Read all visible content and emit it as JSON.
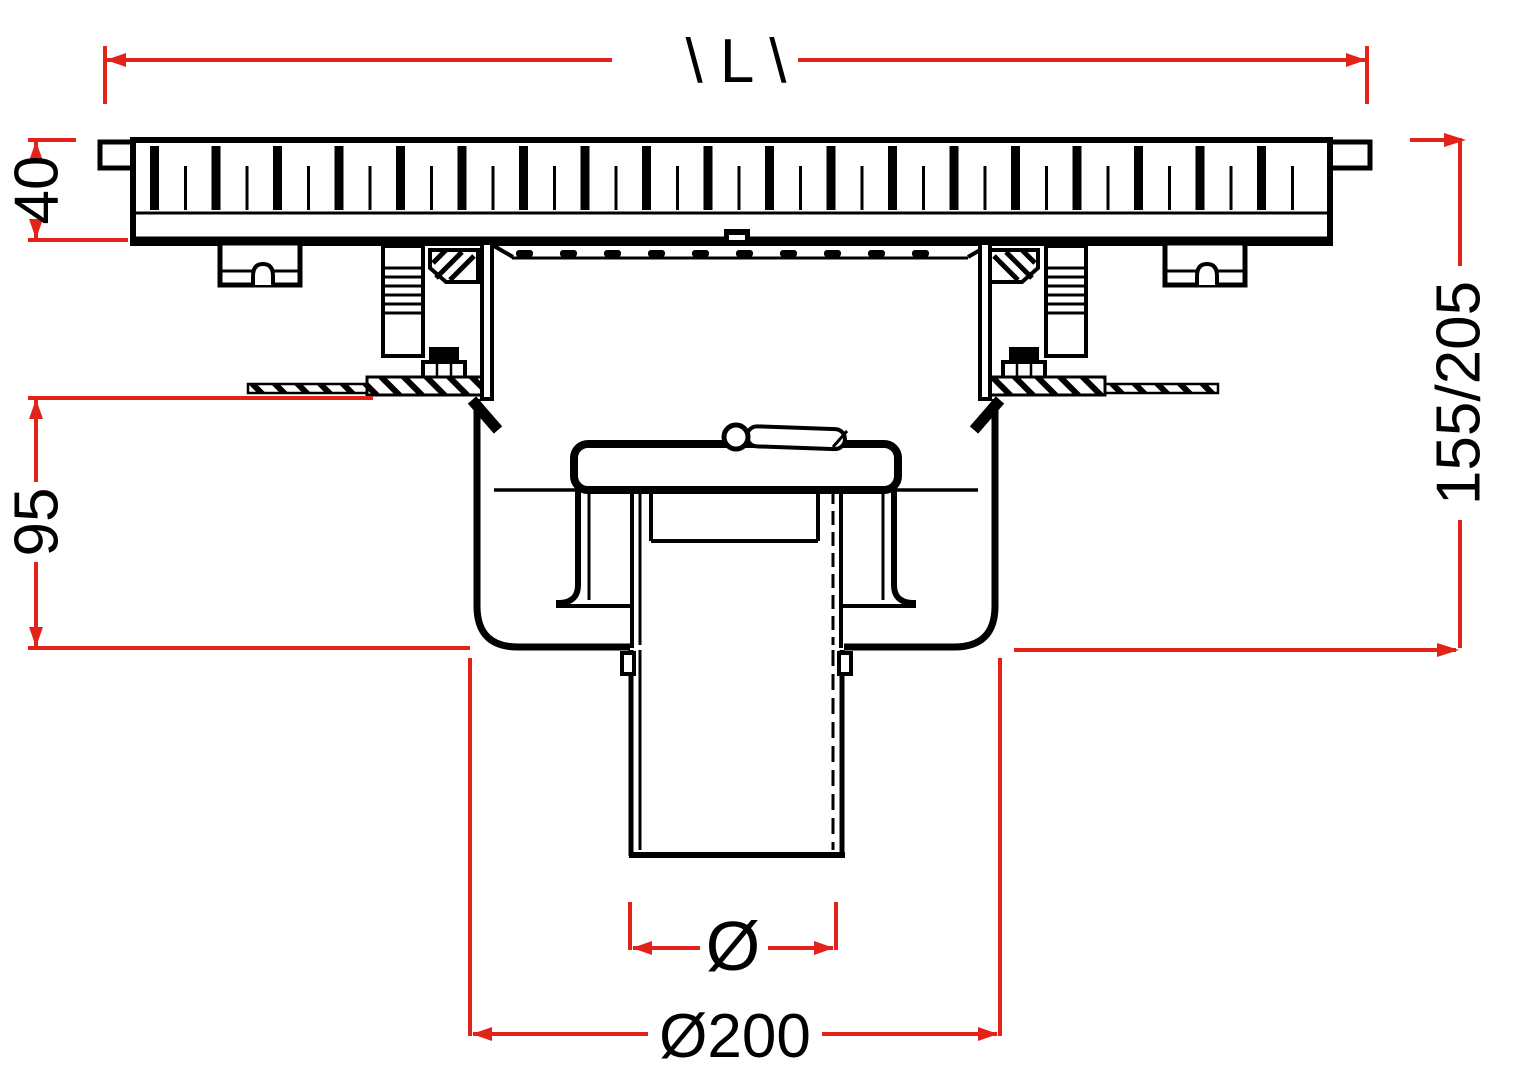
{
  "drawing": {
    "type": "floor-drain cross-section, dimensioned technical drawing",
    "colors": {
      "line": "#000000",
      "dimension": "#e2231a",
      "background": "#ffffff"
    }
  },
  "dimensions": {
    "length_label": "\\ L \\",
    "grate_height": "40",
    "overall_height": "155/205",
    "sump_depth": "95",
    "outlet_diameter_symbol": "Ø",
    "flange_diameter": "Ø200"
  }
}
